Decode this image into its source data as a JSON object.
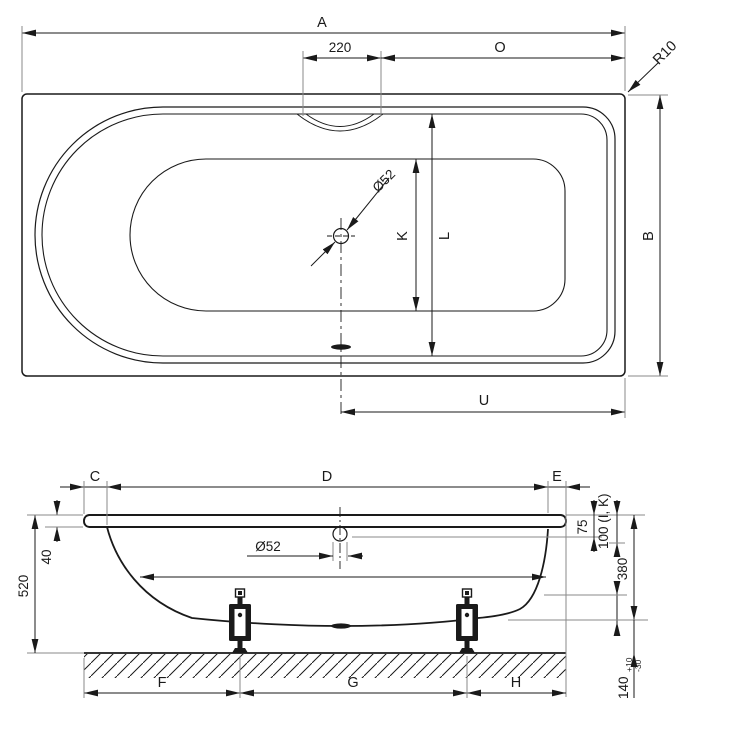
{
  "drawing": {
    "type": "bathtub installation drawing, top view and front section view",
    "colors": {
      "line": "#1a1a1a",
      "extension_line": "#8a8a8a",
      "background": "#ffffff"
    },
    "top": {
      "a": "A",
      "recess_width": "220",
      "o": "O",
      "corner_radius": "R10",
      "drain_diameter": "Ø52",
      "k": "K",
      "l": "L",
      "b": "B",
      "u": "U"
    },
    "side": {
      "c": "C",
      "d": "D",
      "e": "E",
      "rim_height": "40",
      "total_height": "520",
      "drain_diameter": "Ø52",
      "overflow_depth": "75",
      "measure_note": "100 (I, K)",
      "shell_height": "380",
      "foot_height": "140",
      "foot_tol_plus": "+10",
      "foot_tol_minus": "-30",
      "f": "F",
      "g": "G",
      "h": "H"
    }
  }
}
